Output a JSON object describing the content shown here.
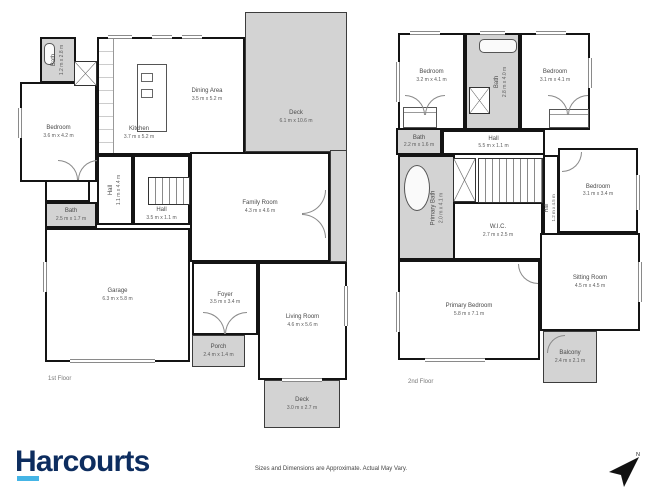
{
  "branding": {
    "logo_text": "Harcourts",
    "disclaimer": "Sizes and Dimensions are Approximate. Actual May Vary."
  },
  "compass": {
    "label": "N"
  },
  "colors": {
    "wall": "#141414",
    "outdoor_fill": "#d3d3d3",
    "logo_navy": "#0d2d5f",
    "logo_cyan": "#45b5e6"
  },
  "floor1": {
    "label": "1st Floor",
    "rooms": {
      "bath_top": {
        "name": "Bath",
        "dims": "1.2 m x 2.8 m"
      },
      "bedroom": {
        "name": "Bedroom",
        "dims": "3.6 m x 4.2 m"
      },
      "kitchen": {
        "name": "Kitchen",
        "dims": "3.7 m x 5.2 m"
      },
      "dining_area": {
        "name": "Dining Area",
        "dims": "3.5 m x 5.2 m"
      },
      "deck_top": {
        "name": "Deck",
        "dims": "6.1 m x 10.6 m"
      },
      "family_room": {
        "name": "Family Room",
        "dims": "4.3 m x 4.6 m"
      },
      "hall_v": {
        "name": "Hall",
        "dims": "1.1 m x 4.4 m"
      },
      "hall_h": {
        "name": "Hall",
        "dims": "3.5 m x 1.1 m"
      },
      "bath_mid": {
        "name": "Bath",
        "dims": "2.5 m x 1.7 m"
      },
      "garage": {
        "name": "Garage",
        "dims": "6.3 m x 5.8 m"
      },
      "foyer": {
        "name": "Foyer",
        "dims": "3.5 m x 3.4 m"
      },
      "porch": {
        "name": "Porch",
        "dims": "2.4 m x 1.4 m"
      },
      "living_room": {
        "name": "Living Room",
        "dims": "4.6 m x 5.6 m"
      },
      "deck_bottom": {
        "name": "Deck",
        "dims": "3.0 m x 2.7 m"
      }
    }
  },
  "floor2": {
    "label": "2nd Floor",
    "rooms": {
      "bedroom_tl": {
        "name": "Bedroom",
        "dims": "3.2 m x 4.1 m"
      },
      "bath_top": {
        "name": "Bath",
        "dims": "2.8 m x 4.0 m"
      },
      "bedroom_tr": {
        "name": "Bedroom",
        "dims": "3.1 m x 4.1 m"
      },
      "bath_left": {
        "name": "Bath",
        "dims": "2.2 m x 1.6 m"
      },
      "hall_h": {
        "name": "Hall",
        "dims": "5.5 m x 1.1 m"
      },
      "primary_bath": {
        "name": "Primary Bath",
        "dims": "2.0 m x 4.1 m"
      },
      "wic": {
        "name": "W.I.C.",
        "dims": "2.7 m x 2.5 m"
      },
      "hall_v": {
        "name": "Hall",
        "dims": "1.2 m x 4.5 m"
      },
      "bedroom_r": {
        "name": "Bedroom",
        "dims": "3.1 m x 3.4 m"
      },
      "sitting_room": {
        "name": "Sitting Room",
        "dims": "4.5 m x 4.5 m"
      },
      "primary_bedroom": {
        "name": "Primary Bedroom",
        "dims": "5.8 m x 7.1 m"
      },
      "balcony": {
        "name": "Balcony",
        "dims": "2.4 m x 2.1 m"
      }
    }
  }
}
